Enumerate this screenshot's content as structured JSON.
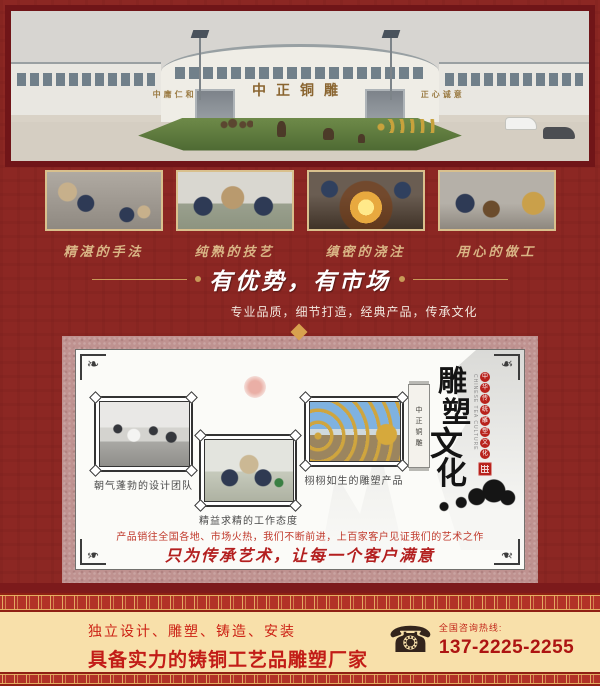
{
  "colors": {
    "page_bg": "#8c2723",
    "page_border": "#701518",
    "gold_accent": "#d9b585",
    "panel_frame": "#bf9290",
    "footer_bg": "#f8e0aa",
    "footer_red": "#c21c17",
    "seal_red": "#b8221c"
  },
  "hero": {
    "sign_left": "中庸仁和",
    "sign_center": "中正铜雕",
    "sign_right": "正心诚意"
  },
  "process_photos": [
    {
      "caption": "精湛的手法"
    },
    {
      "caption": "纯熟的技艺"
    },
    {
      "caption": "缜密的浇注"
    },
    {
      "caption": "用心的做工"
    }
  ],
  "slogan": {
    "heading": "有优势，有市场",
    "subtitle": "专业品质，细节打造，经典产品，传承文化"
  },
  "panel": {
    "photos": [
      {
        "caption": "朝气蓬勃的设计团队"
      },
      {
        "caption": "精益求精的工作态度"
      },
      {
        "caption": "栩栩如生的雕塑产品"
      }
    ],
    "vertical_art": {
      "banner_chars": [
        "中",
        "正",
        "铜",
        "雕"
      ],
      "title_chars": [
        "雕",
        "塑",
        "文",
        "化"
      ],
      "medallion_chars": [
        "中",
        "华",
        "传",
        "统",
        "雕",
        "塑",
        "文",
        "化"
      ],
      "english": "CHINESE TEA CULTURE"
    },
    "desc_line": "产品销往全国各地、市场火热，我们不断前进，上百家客户见证我们的艺术之作",
    "script_line": "只为传承艺术，让每一个客户满意"
  },
  "footer": {
    "line1": "独立设计、雕塑、铸造、安装",
    "line2": "具备实力的铸铜工艺品雕塑厂家",
    "hotline_label": "全国咨询热线:",
    "phone": "137-2225-2255"
  }
}
